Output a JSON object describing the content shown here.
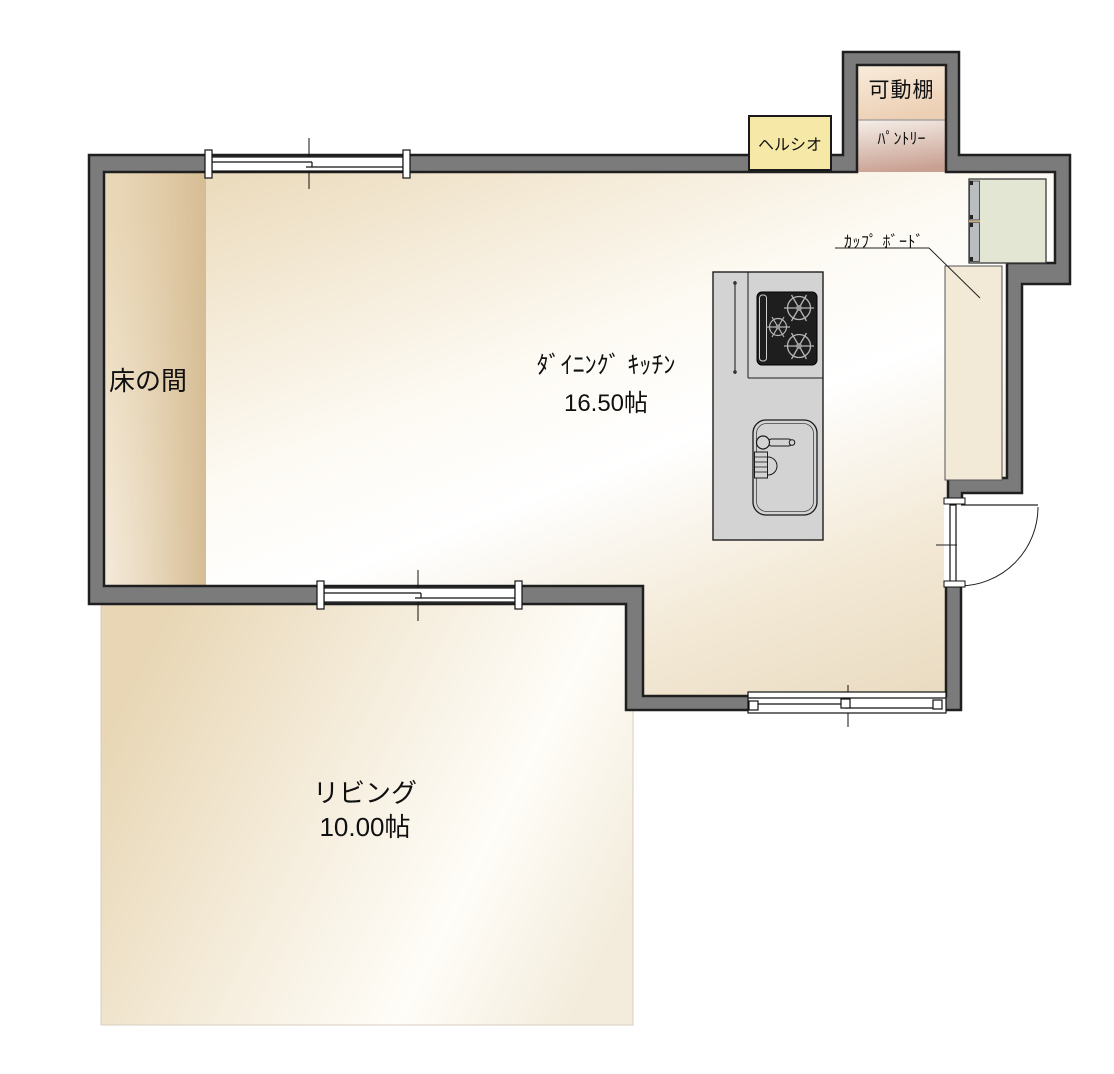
{
  "rooms": {
    "dining_kitchen": {
      "label": "ﾀﾞｲﾆﾝｸﾞ ｷｯﾁﾝ",
      "area": "16.50帖"
    },
    "living": {
      "label": "リビング",
      "area": "10.00帖"
    },
    "tokonoma": {
      "label": "床の間"
    },
    "pantry": {
      "label": "ﾊﾟﾝﾄﾘｰ",
      "shelf_label": "可動棚"
    }
  },
  "fixtures": {
    "healsio": {
      "label": "ヘルシオ"
    },
    "cupboard": {
      "label": "ｶｯﾌﾟ ﾎﾞｰﾄﾞ"
    },
    "kitchen_island": {
      "items": [
        "gas-cooktop",
        "kitchen-sink"
      ]
    },
    "door": {
      "type": "hinged-door"
    },
    "windows": {
      "type": "sliding-window",
      "count": 3
    }
  },
  "colors": {
    "wall": "#7b7b7b",
    "wall_outline": "#1f1f1f",
    "floor_tan": "#e8d6b5",
    "floor_highlight": "#ffffff",
    "tokonoma_tan": "#d9c19b",
    "shelf_peach": "#eed2b8",
    "pantry_rose": "#c9a193",
    "healsio_yellow": "#f6e9a8",
    "cabinet_sage": "#e3e6d3",
    "appliance_gray": "#d3d3d3",
    "stove_black": "#1e1e1e"
  }
}
